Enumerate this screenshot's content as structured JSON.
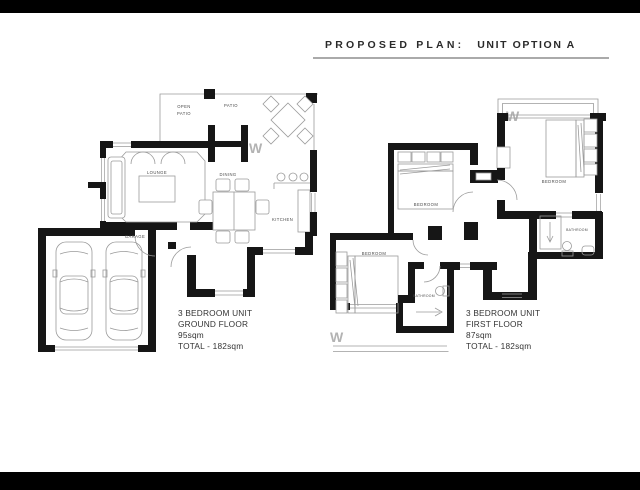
{
  "title": {
    "label": "PROPOSED PLAN:",
    "value": "UNIT OPTION A"
  },
  "ground_floor": {
    "labels": {
      "open_patio_line1": "OPEN",
      "open_patio_line2": "PATIO",
      "patio": "PATIO",
      "lounge": "LOUNGE",
      "dining": "DINING",
      "kitchen": "KITCHEN",
      "garage": "GARAGE",
      "window_marker": "W"
    },
    "info": {
      "unit": "3 BEDROOM UNIT",
      "floor": "GROUND FLOOR",
      "area": "95sqm",
      "total": "TOTAL - 182sqm"
    }
  },
  "first_floor": {
    "labels": {
      "bedroom_middle": "BEDROOM",
      "bedroom_master": "BEDROOM",
      "bedroom_lower": "BEDROOM",
      "bathroom_master": "BATHROOM",
      "bathroom_small": "BATHROOM",
      "balcony_window_marker": "W",
      "lower_window_marker": "W"
    },
    "info": {
      "unit": "3 BEDROOM UNIT",
      "floor": "FIRST FLOOR",
      "area": "87sqm",
      "total": "TOTAL - 182sqm"
    }
  },
  "colors": {
    "background": "#ffffff",
    "letterbox": "#000000",
    "wall": "#161616",
    "line": "#9b9b9b",
    "label": "#4a4a4a",
    "info_text": "#333333",
    "marker": "#b3b3b3",
    "title_text": "#2a2a2a",
    "underline": "#aaaaaa"
  }
}
